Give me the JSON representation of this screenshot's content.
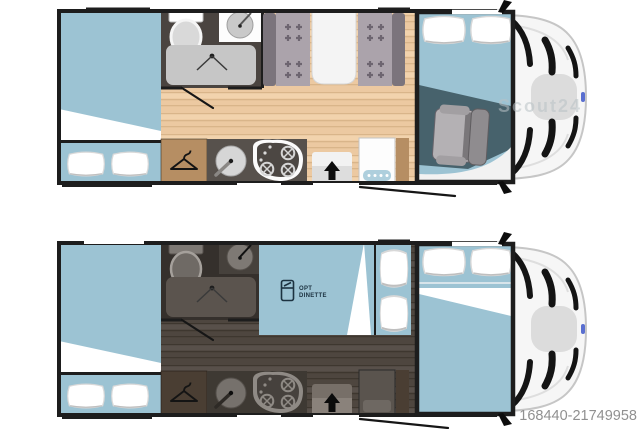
{
  "page": {
    "background": "#ffffff"
  },
  "listing": {
    "id": "168440-21749958"
  },
  "watermark": {
    "text": "Scout24"
  },
  "night_plan": {
    "optional_dinette": {
      "line1": "OPT",
      "line2": "DINETTE",
      "icon": "dinette-fridge-icon"
    }
  },
  "icons": {
    "wardrobe": "hanger-icon",
    "shower": "shower-spray-icon",
    "entry": "entry-arrow-icon",
    "mirror": "wing-mirror-icon",
    "optional_dinette": "dinette-fridge-icon"
  },
  "colors": {
    "page_bg": "#ffffff",
    "wall": "#1d1d1d",
    "bed_blue": "#9cc3d3",
    "wood_floor": "#ecc9a1",
    "wood_floor_night": "#4e463f",
    "wardrobe_wood": "#b68e63",
    "wardrobe_wood_night": "#4a3e33",
    "counter": "#57514c",
    "counter_night": "#3e3933",
    "bath_floor": "#4a4440",
    "bath_floor_night": "#35302c",
    "cab_floor_teal": "#47626c",
    "bench_gray": "#aba3ab",
    "backrest_gray": "#7b747c",
    "table_white": "#f4f4f4",
    "step_blue": "#aecfdd",
    "label_navy": "#1c3240",
    "id_gray": "#909090",
    "watermark_gray": "#b9c2c6"
  }
}
